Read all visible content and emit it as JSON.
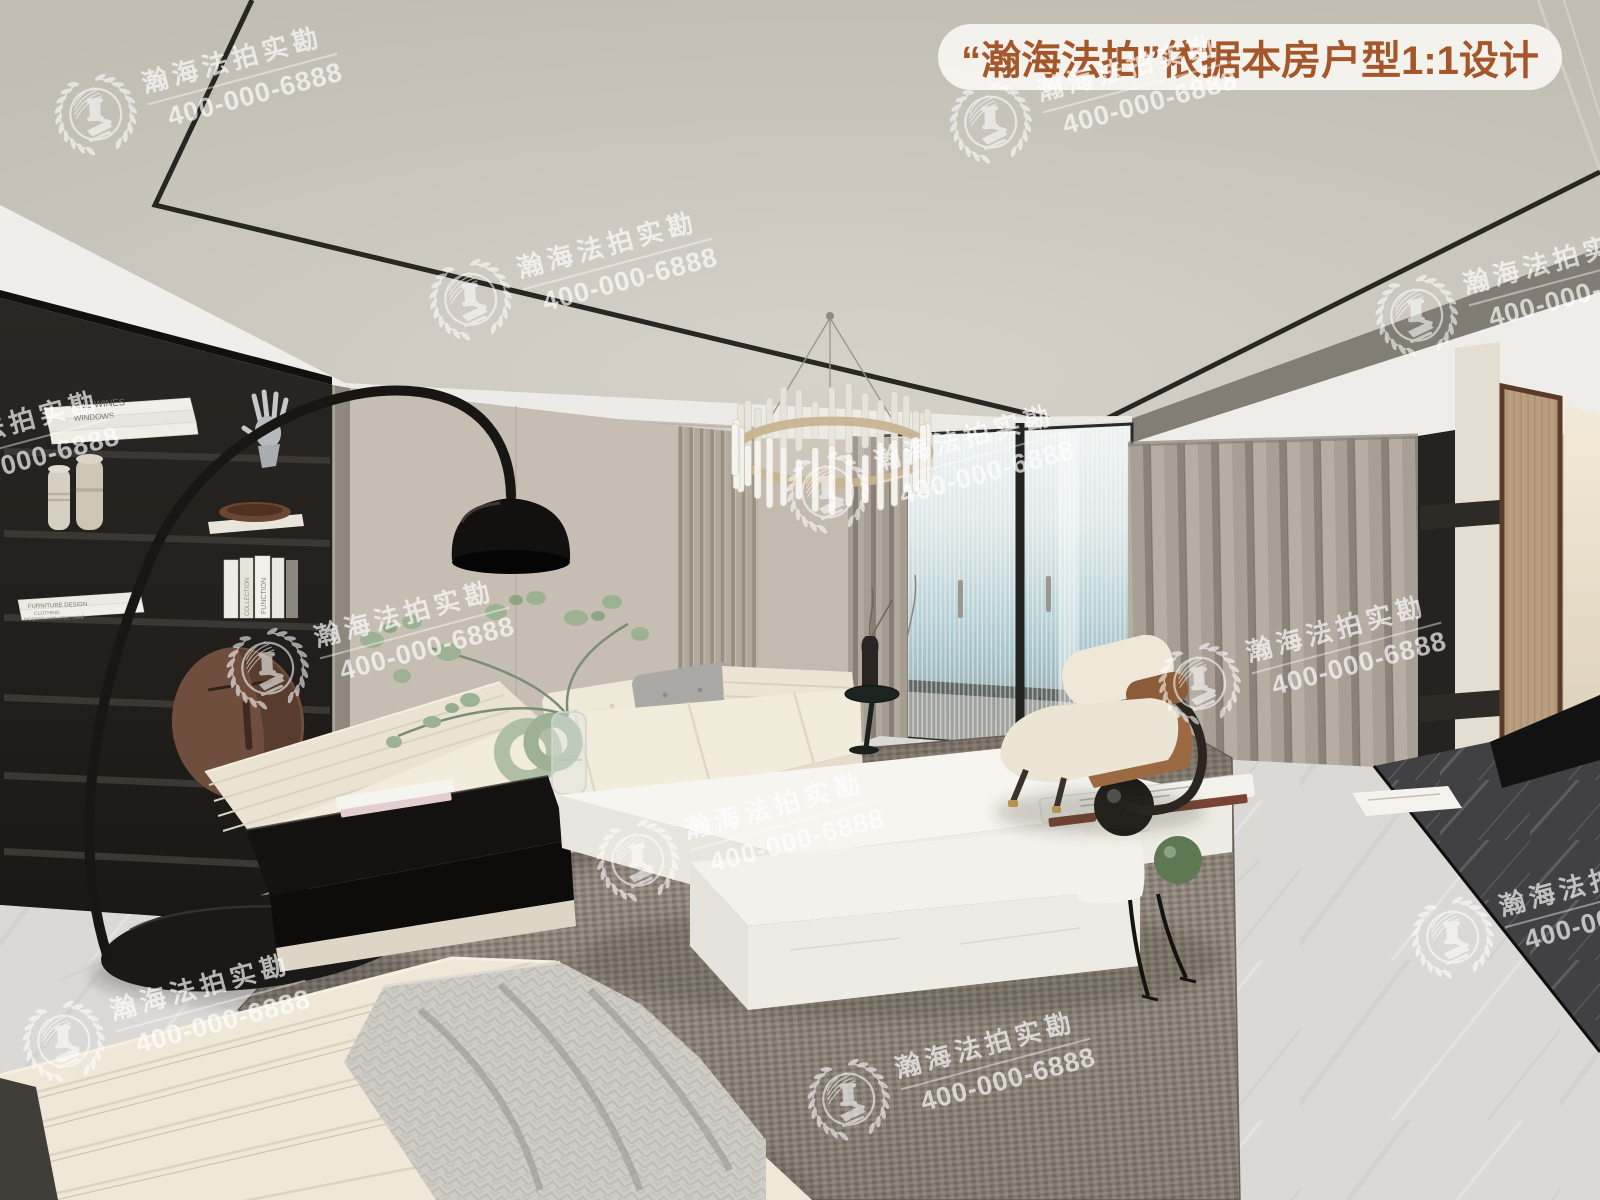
{
  "scene": {
    "subject": "modern living room interior 3D render",
    "book_titles": [
      "FINE WINES",
      "WINDOWS",
      "FURNITURE DESIGN",
      "CLOTHING",
      "MODERN ARCHITECTURE",
      "FUNCTION",
      "COLLECTION"
    ]
  },
  "badge": {
    "text": "“瀚海法拍”依据本房户型1:1设计",
    "text_color": "#a4572a",
    "background": "rgba(252,250,246,0.86)"
  },
  "watermark": {
    "name": "瀚海法拍实勘",
    "phone": "400-000-6888",
    "color": "#ffffff",
    "opacity": 0.62,
    "logo": "laurel-gavel-emblem",
    "instances": [
      {
        "x": 48,
        "y": 31
      },
      {
        "x": 423,
        "y": 216
      },
      {
        "x": 943,
        "y": 39
      },
      {
        "x": 1369,
        "y": 232
      },
      {
        "x": -175,
        "y": 395
      },
      {
        "x": 780,
        "y": 409
      },
      {
        "x": 220,
        "y": 585
      },
      {
        "x": 1152,
        "y": 600
      },
      {
        "x": 590,
        "y": 777
      },
      {
        "x": 16,
        "y": 958
      },
      {
        "x": 801,
        "y": 1016
      },
      {
        "x": 1405,
        "y": 854
      }
    ]
  },
  "palette": {
    "ceiling": "#cbc6be",
    "wall_beige": "#c6beb2",
    "bookshelf": "#26221f",
    "sofa_cream": "#efe8d9",
    "rug_taupe": "#968d82",
    "curtain_gray": "#a59d93",
    "accent_brown": "#9c6a42",
    "marble_floor": "#d9d7d4",
    "marble_plinth": "#3f3e40",
    "wood_panel": "#b49a7c",
    "badge_text": "#a4572a"
  }
}
